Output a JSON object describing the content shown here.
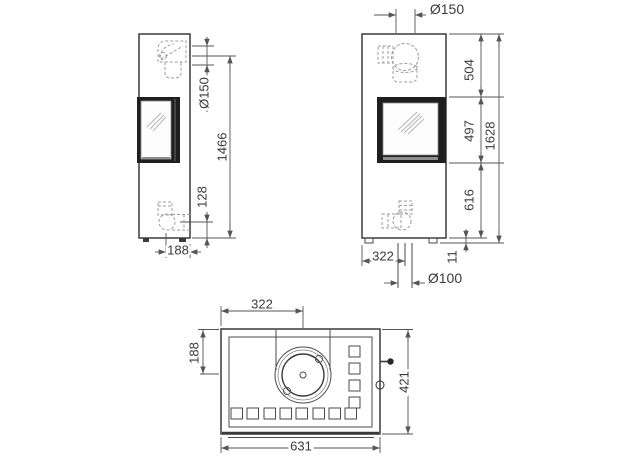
{
  "drawing": {
    "title": "stove-dimension-drawing",
    "colors": {
      "line": "#3a3a3a",
      "hidden": "#9c9c9c",
      "door_frame": "#1f1f1f",
      "background": "#ffffff"
    },
    "side": {
      "flue_diameter": "Ø150",
      "outlet_height": "1466",
      "rear_outlet_height": "128",
      "rear_outlet_offset": "188"
    },
    "front": {
      "flue_diameter": "Ø150",
      "top_section": "504",
      "door_height": "497",
      "total_height": "1628",
      "lower_section": "616",
      "feet_height": "11",
      "outlet_offset": "322",
      "lower_flue_diameter": "Ø100"
    },
    "top": {
      "flue_offset_x": "322",
      "flue_offset_y": "188",
      "depth": "421",
      "width": "631"
    }
  }
}
